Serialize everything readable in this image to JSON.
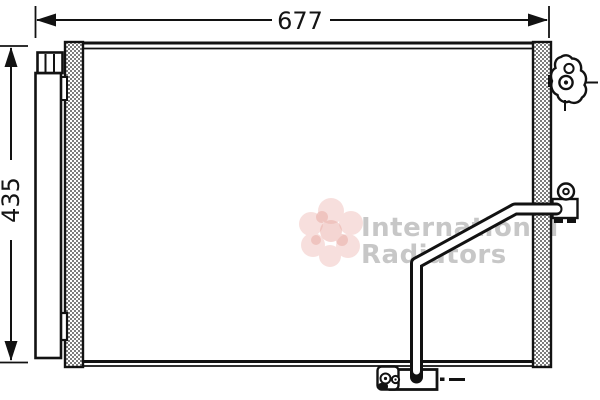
{
  "drawing": {
    "type": "technical-part-diagram",
    "part": "automotive condenser with pipe and mounting brackets",
    "dim_width_label": "677",
    "dim_height_label": "435"
  },
  "watermark": {
    "brand_line1": "International",
    "brand_line2": "Radiators",
    "text_color": "#c7c7c7",
    "flower_color_light": "#f2c6c2",
    "flower_color_dark": "#e7a49c"
  },
  "style": {
    "line_color": "#121212",
    "hatch_color": "#7d7d7d",
    "background": "#ffffff"
  }
}
